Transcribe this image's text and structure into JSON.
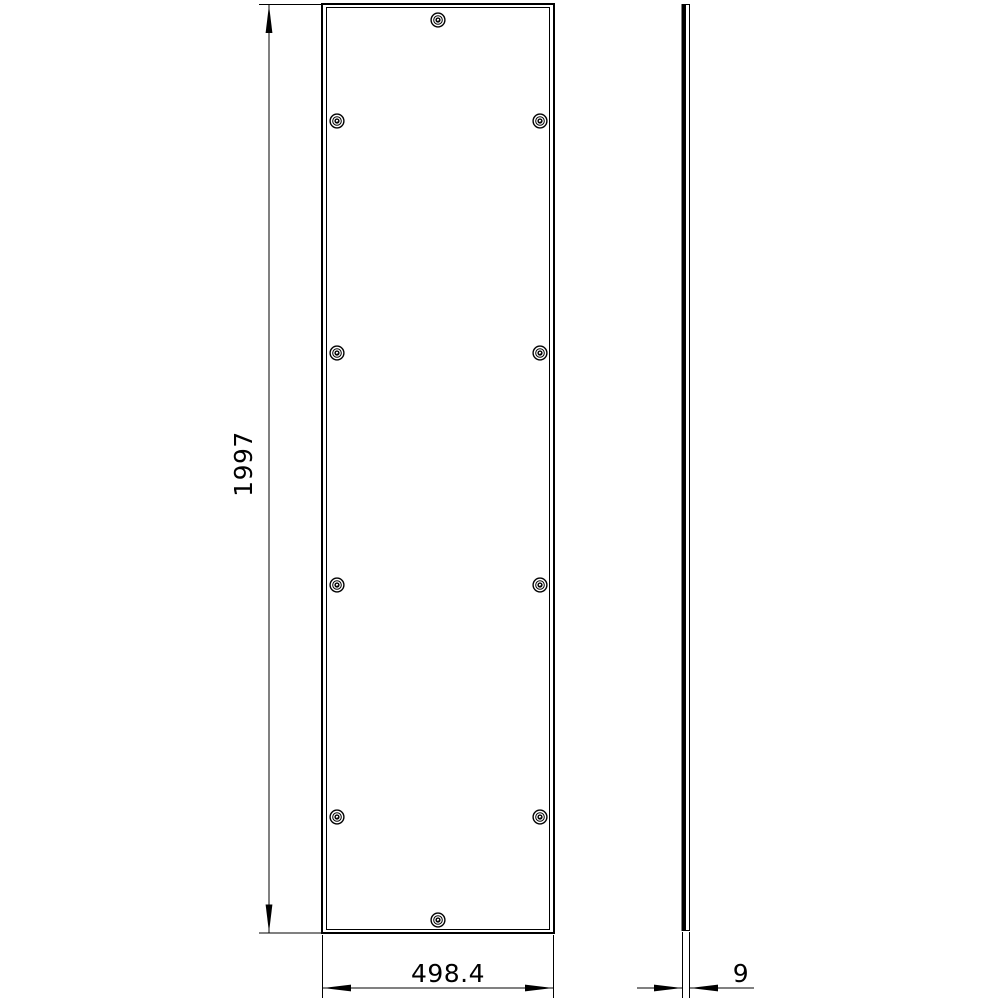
{
  "colors": {
    "background": "#ffffff",
    "line": "#000000"
  },
  "drawing": {
    "kind": "technical-drawing",
    "views": {
      "front": {
        "label": "front-view-of-panel",
        "fastener_count": 10
      },
      "side": {
        "label": "side-profile-view"
      }
    },
    "dimensions": {
      "height": "1997",
      "width": "498.4",
      "thickness": "9"
    }
  }
}
